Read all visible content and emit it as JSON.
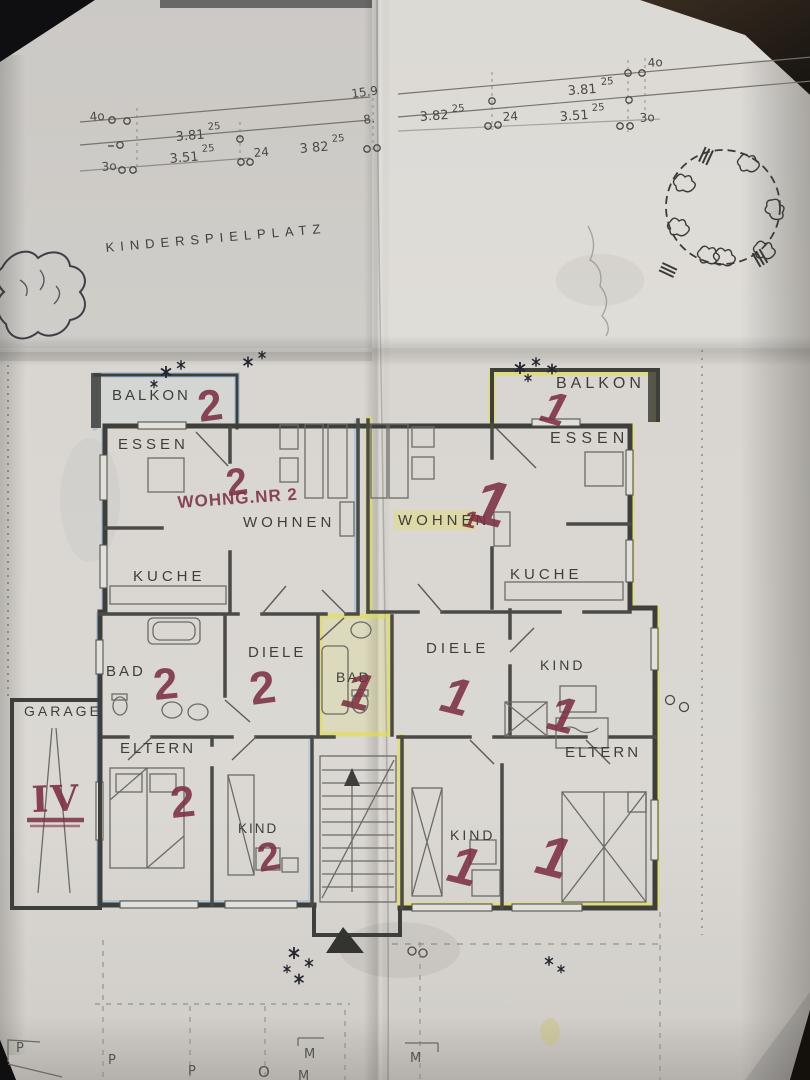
{
  "site": {
    "playground_label": "KINDERSPIELPLATZ",
    "left_dims": {
      "forty": "4o",
      "thirty": "3o",
      "twentyfour": "24",
      "dim1": "3.81",
      "dim1_sup": "25",
      "dim2": "3.51",
      "dim2_sup": "25",
      "dim3": "3 82",
      "dim3_sup": "25",
      "total_a": "15.9",
      "total_b": "8."
    },
    "right_dims": {
      "forty": "4o",
      "thirty": "3o",
      "twentyfour": "24",
      "dim1": "3.81",
      "dim1_sup": "25",
      "dim2": "3.82",
      "dim2_sup": "25",
      "dim3": "3.51",
      "dim3_sup": "25"
    }
  },
  "rooms": {
    "balkon": "BALKON",
    "essen": "ESSEN",
    "wohnen": "WOHNEN",
    "kueche": "KUCHE",
    "bad": "BAD",
    "diele": "DIELE",
    "eltern": "ELTERN",
    "kind": "KIND",
    "garage": "GARAGE"
  },
  "marks": {
    "one": "1",
    "two": "2",
    "garage_roman": "IV",
    "unit2_note": "WOHNG.NR 2",
    "unit1_note": "1"
  },
  "parking": {
    "p": "P",
    "m": "M",
    "o": "O"
  },
  "colors": {
    "marker_red": "#7c3142",
    "highlight_yellow": "#e4e04a",
    "highlight_blue": "#8fb9dd",
    "paper": "#d7d4cf",
    "ink": "#3c3c38"
  }
}
